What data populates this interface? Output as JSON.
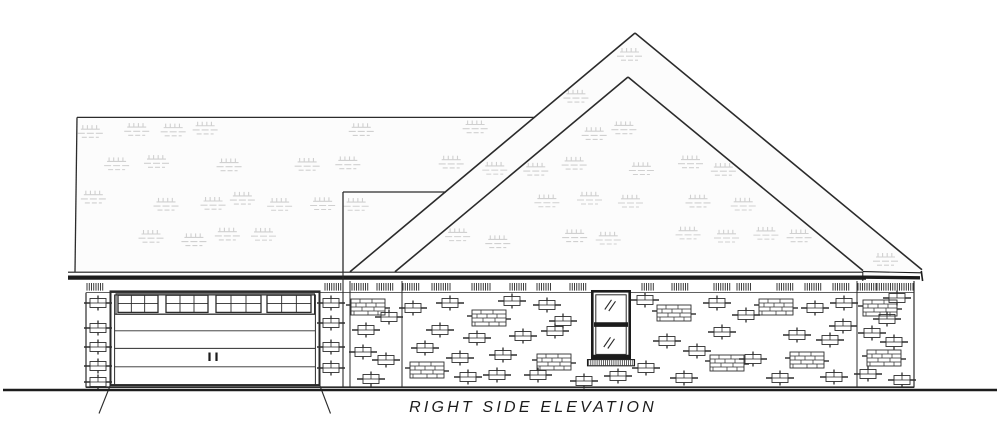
{
  "title": {
    "text": "RIGHT SIDE ELEVATION"
  },
  "palette": {
    "background": "#ffffff",
    "ink": "#2b2b2b",
    "ink_heavy": "#1c1c1c",
    "roof_fill": "#fcfcfc",
    "tuft": "#d0d0d0",
    "brick": "#2e2e2e"
  },
  "canvas": {
    "width": 1000,
    "height": 421
  },
  "roof": {
    "fill_polygon": [
      [
        75,
        272
      ],
      [
        77,
        117.5
      ],
      [
        535,
        117.5
      ],
      [
        635,
        33
      ],
      [
        922,
        270
      ]
    ],
    "outline_lines": [
      [
        77,
        117.4,
        535,
        117.4,
        1.3
      ],
      [
        77,
        117.4,
        75,
        271.8,
        1.3
      ],
      [
        343,
        192,
        446,
        192,
        1.3
      ],
      [
        343,
        192,
        343,
        271.8,
        1.3
      ],
      [
        635,
        33,
        350,
        271.8,
        1.6
      ],
      [
        628,
        77,
        395,
        271.8,
        1.6
      ],
      [
        635,
        33,
        922,
        269.8,
        1.6
      ],
      [
        628,
        77,
        863,
        270.6,
        1.6
      ]
    ],
    "right_band": {
      "outer": [
        635,
        33,
        922,
        269.8
      ],
      "inner": [
        628,
        77,
        863,
        270.6
      ]
    },
    "margin_lines": [
      [
        77,
        117.4,
        535,
        117.4
      ],
      [
        77,
        117.4,
        75,
        271.8
      ],
      [
        343,
        192,
        446,
        192
      ],
      [
        343,
        192,
        343,
        271.8
      ],
      [
        635,
        33,
        350,
        271.8
      ],
      [
        628,
        77,
        395,
        271.8
      ],
      [
        635,
        33,
        922,
        269.8
      ],
      [
        628,
        77,
        863,
        270.6
      ]
    ],
    "tuft_grid": {
      "y0": 59,
      "dy": 36,
      "y_max": 239,
      "x0": 58,
      "dx": 38,
      "x_max": 940,
      "row_offset": 19,
      "skip_below": 0.34,
      "margin": 9
    },
    "extra_tufts": [
      [
        630,
        56
      ],
      [
        886,
        261
      ]
    ]
  },
  "fascia": {
    "lines": [
      [
        68,
        272.2,
        863,
        272.2,
        1.1
      ],
      [
        68,
        277.6,
        866,
        277.6,
        4.2
      ],
      [
        863,
        271.6,
        921.5,
        272.8,
        1.1
      ],
      [
        866,
        277.2,
        920,
        277.8,
        3.4
      ],
      [
        921.3,
        271,
        922.6,
        281,
        1.6
      ],
      [
        862.8,
        271.5,
        862.8,
        281,
        1.0
      ]
    ]
  },
  "frieze": {
    "tick_top": 283,
    "tick_bottom": 290.6,
    "tick_step": 2.25,
    "tick_w": 0.85,
    "groups": [
      [
        87,
        17
      ],
      [
        325,
        17
      ],
      [
        352,
        16
      ],
      [
        377,
        17
      ],
      [
        403,
        17
      ],
      [
        432,
        18
      ],
      [
        472,
        18
      ],
      [
        510,
        16
      ],
      [
        537,
        15
      ],
      [
        570,
        16
      ],
      [
        642,
        13
      ],
      [
        672,
        17
      ],
      [
        714,
        16
      ],
      [
        737,
        15
      ],
      [
        777,
        16
      ],
      [
        805,
        17
      ],
      [
        833,
        17
      ],
      [
        858,
        18
      ],
      [
        877,
        17
      ],
      [
        895,
        18
      ]
    ]
  },
  "walls": {
    "lines": [
      [
        86,
        292.6,
        591,
        292.6,
        0.8
      ],
      [
        631,
        292.6,
        914,
        292.6,
        0.8
      ],
      [
        86,
        292.6,
        86,
        387.6,
        1.2
      ],
      [
        343,
        271.8,
        343,
        387.6,
        1.1
      ],
      [
        350,
        281,
        350,
        387.6,
        1.0
      ],
      [
        402,
        281,
        402,
        387.6,
        1.0
      ],
      [
        857,
        281,
        857,
        387.6,
        1.0
      ],
      [
        914,
        281,
        914,
        387.6,
        1.2
      ],
      [
        86,
        387.2,
        914,
        387.2,
        1.6
      ]
    ]
  },
  "ground": [
    3,
    390,
    997,
    390,
    2.4
  ],
  "driveway": [
    [
      110,
      386,
      99,
      413.5,
      1.1
    ],
    [
      320,
      386,
      330.5,
      413.5,
      1.1
    ]
  ],
  "garage": {
    "outer_rect": [
      110.5,
      291.4,
      209,
      93.8,
      2.0
    ],
    "inner_rect": [
      114.6,
      295,
      200.8,
      90.2,
      1.0
    ],
    "transom_rect": [
      116,
      293.8,
      198.5,
      20.4,
      1.0
    ],
    "transom_groups": [
      [
        118,
        158
      ],
      [
        166,
        208
      ],
      [
        216,
        261
      ],
      [
        267,
        311
      ]
    ],
    "transom_top": 295.2,
    "transom_bot": 312.4,
    "transom_mid": 303.6,
    "transom_cols": 3,
    "panel_lines": [
      330.8,
      348.4,
      366.8
    ],
    "panel_x1": 114.6,
    "panel_x2": 315.4,
    "bottom_line": [
      110,
      385,
      320,
      385,
      1.8
    ],
    "handles": [
      [
        209.5,
        352.5,
        209.5,
        361
      ],
      [
        216.5,
        352.5,
        216.5,
        361
      ]
    ]
  },
  "window": {
    "outer_rect": [
      592.3,
      291.3,
      37.4,
      66.6,
      2.6
    ],
    "inner_rect": [
      595.8,
      294.8,
      30.4,
      59.6,
      1.0
    ],
    "rail": [
      594,
      324.6,
      628,
      324.6,
      4.6
    ],
    "hatches": [
      [
        604.8,
        309.5,
        611.5,
        299.8
      ],
      [
        608.8,
        311,
        615.5,
        301.3
      ],
      [
        603.8,
        347,
        610.5,
        337.3
      ],
      [
        607.8,
        348.5,
        614.5,
        338.8
      ]
    ],
    "bottom_rail": [
      593,
      356.3,
      629,
      356.3,
      3.2
    ],
    "sill_rect": [
      587.5,
      359.6,
      47,
      6.2,
      1.1
    ],
    "sill_tick_step": 2.1
  },
  "bricks": {
    "singles": [
      [
        98,
        303
      ],
      [
        98,
        328
      ],
      [
        98,
        347
      ],
      [
        98,
        366
      ],
      [
        98,
        382
      ],
      [
        331,
        303
      ],
      [
        331,
        323
      ],
      [
        331,
        347
      ],
      [
        331,
        368
      ],
      [
        389,
        317
      ],
      [
        366,
        330
      ],
      [
        363,
        352
      ],
      [
        386,
        360
      ],
      [
        371,
        379
      ],
      [
        413,
        308
      ],
      [
        450,
        303
      ],
      [
        512,
        301
      ],
      [
        547,
        305
      ],
      [
        563,
        321
      ],
      [
        440,
        330
      ],
      [
        477,
        338
      ],
      [
        523,
        336
      ],
      [
        555,
        331
      ],
      [
        425,
        348
      ],
      [
        460,
        358
      ],
      [
        503,
        355
      ],
      [
        468,
        377
      ],
      [
        497,
        375
      ],
      [
        538,
        375
      ],
      [
        584,
        381
      ],
      [
        618,
        376
      ],
      [
        645,
        300
      ],
      [
        717,
        303
      ],
      [
        815,
        308
      ],
      [
        844,
        303
      ],
      [
        746,
        315
      ],
      [
        722,
        332
      ],
      [
        797,
        335
      ],
      [
        843,
        326
      ],
      [
        830,
        340
      ],
      [
        667,
        341
      ],
      [
        697,
        351
      ],
      [
        753,
        359
      ],
      [
        646,
        368
      ],
      [
        684,
        378
      ],
      [
        780,
        378
      ],
      [
        834,
        377
      ],
      [
        897,
        298
      ],
      [
        887,
        319
      ],
      [
        872,
        333
      ],
      [
        894,
        342
      ],
      [
        868,
        374
      ],
      [
        902,
        380
      ]
    ],
    "clusters": [
      [
        368,
        307
      ],
      [
        489,
        318
      ],
      [
        554,
        362
      ],
      [
        427,
        370
      ],
      [
        674,
        313
      ],
      [
        776,
        307
      ],
      [
        727,
        363
      ],
      [
        807,
        360
      ],
      [
        880,
        308
      ],
      [
        884,
        358
      ]
    ]
  }
}
